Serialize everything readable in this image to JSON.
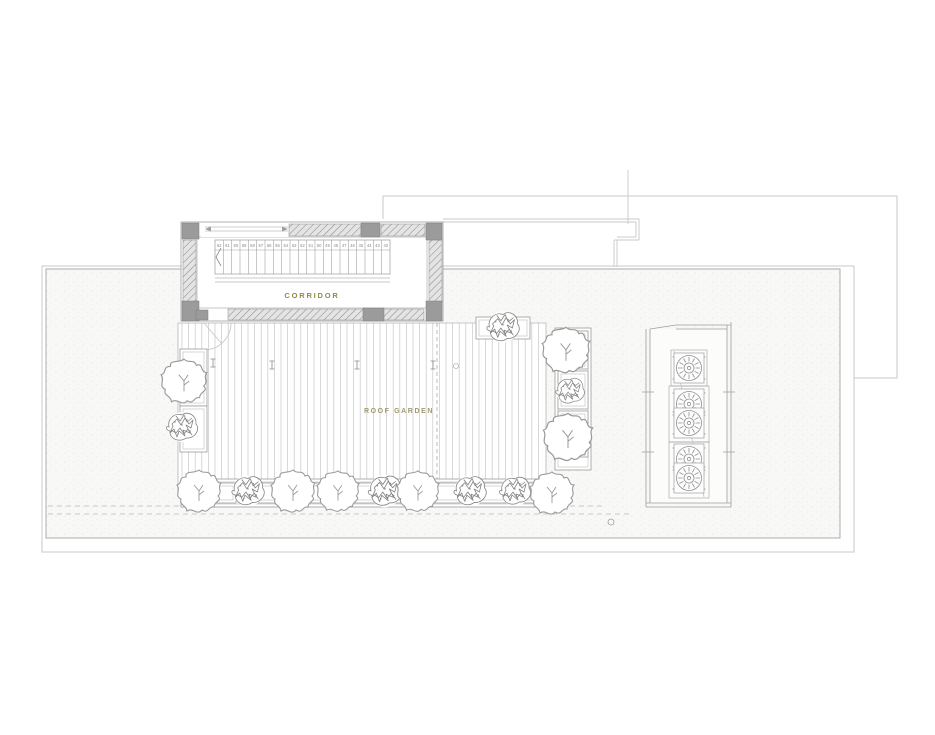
{
  "meta": {
    "width": 935,
    "height": 735,
    "drawing_type": "roof plan"
  },
  "labels": {
    "corridor": "CORRIDOR",
    "roof_garden": "ROOF GARDEN"
  },
  "colors": {
    "label_corridor": "#8d8d4a",
    "label_garden": "#a29a70",
    "hatch_line": "#8d8d8d",
    "column": "#9b9b9b",
    "outline_light": "#c9c9c9",
    "outline_mid": "#9f9f9f",
    "plank": "#c7c7c9",
    "plant": "#9a9a9a"
  },
  "stair": {
    "x0": 215,
    "x1": 390,
    "y0": 240,
    "y1": 274,
    "tread_numbers": [
      "62",
      "61",
      "60",
      "59",
      "58",
      "57",
      "56",
      "55",
      "54",
      "53",
      "52",
      "51",
      "50",
      "49",
      "48",
      "47",
      "46",
      "45",
      "44",
      "43",
      "42"
    ]
  },
  "deck": {
    "x0": 182,
    "x1": 544,
    "y0": 323,
    "y1": 491,
    "step": 6.6,
    "joint_x": 437,
    "drains": [
      [
        213,
        363
      ],
      [
        272,
        365
      ],
      [
        357,
        365
      ],
      [
        433,
        365
      ]
    ],
    "vent_circle": [
      456,
      366
    ]
  },
  "fans": {
    "count": 5,
    "centers": [
      [
        689,
        368
      ],
      [
        689,
        404
      ],
      [
        689,
        423
      ],
      [
        689,
        459
      ],
      [
        689,
        478
      ]
    ]
  },
  "planters": {
    "boxes": [
      [
        180,
        349,
        27,
        57
      ],
      [
        180,
        406,
        27,
        46
      ],
      [
        476,
        317,
        54,
        22
      ],
      [
        555,
        328,
        36,
        142
      ],
      [
        558,
        331,
        30,
        38
      ],
      [
        558,
        371,
        30,
        38
      ],
      [
        558,
        411,
        30,
        46
      ],
      [
        181,
        479,
        365,
        28
      ],
      [
        185,
        483,
        51,
        20
      ],
      [
        240,
        483,
        52,
        20
      ],
      [
        296,
        483,
        52,
        20
      ],
      [
        352,
        483,
        52,
        20
      ],
      [
        408,
        483,
        52,
        20
      ],
      [
        464,
        483,
        52,
        20
      ],
      [
        520,
        483,
        22,
        20
      ]
    ],
    "plants": [
      {
        "type": "leaf",
        "x": 184,
        "y": 382,
        "s": 52
      },
      {
        "type": "bush",
        "x": 182,
        "y": 427,
        "s": 50
      },
      {
        "type": "bush",
        "x": 503,
        "y": 327,
        "s": 52
      },
      {
        "type": "leaf",
        "x": 566,
        "y": 351,
        "s": 54
      },
      {
        "type": "bush",
        "x": 570,
        "y": 391,
        "s": 46
      },
      {
        "type": "leaf",
        "x": 568,
        "y": 438,
        "s": 56
      },
      {
        "type": "leaf",
        "x": 199,
        "y": 492,
        "s": 50
      },
      {
        "type": "bush",
        "x": 248,
        "y": 491,
        "s": 52
      },
      {
        "type": "leaf",
        "x": 293,
        "y": 492,
        "s": 50
      },
      {
        "type": "leaf",
        "x": 338,
        "y": 492,
        "s": 48
      },
      {
        "type": "bush",
        "x": 385,
        "y": 491,
        "s": 54
      },
      {
        "type": "leaf",
        "x": 418,
        "y": 492,
        "s": 48
      },
      {
        "type": "bush",
        "x": 470,
        "y": 491,
        "s": 52
      },
      {
        "type": "bush",
        "x": 515,
        "y": 491,
        "s": 50
      },
      {
        "type": "leaf",
        "x": 552,
        "y": 494,
        "s": 50
      }
    ]
  }
}
